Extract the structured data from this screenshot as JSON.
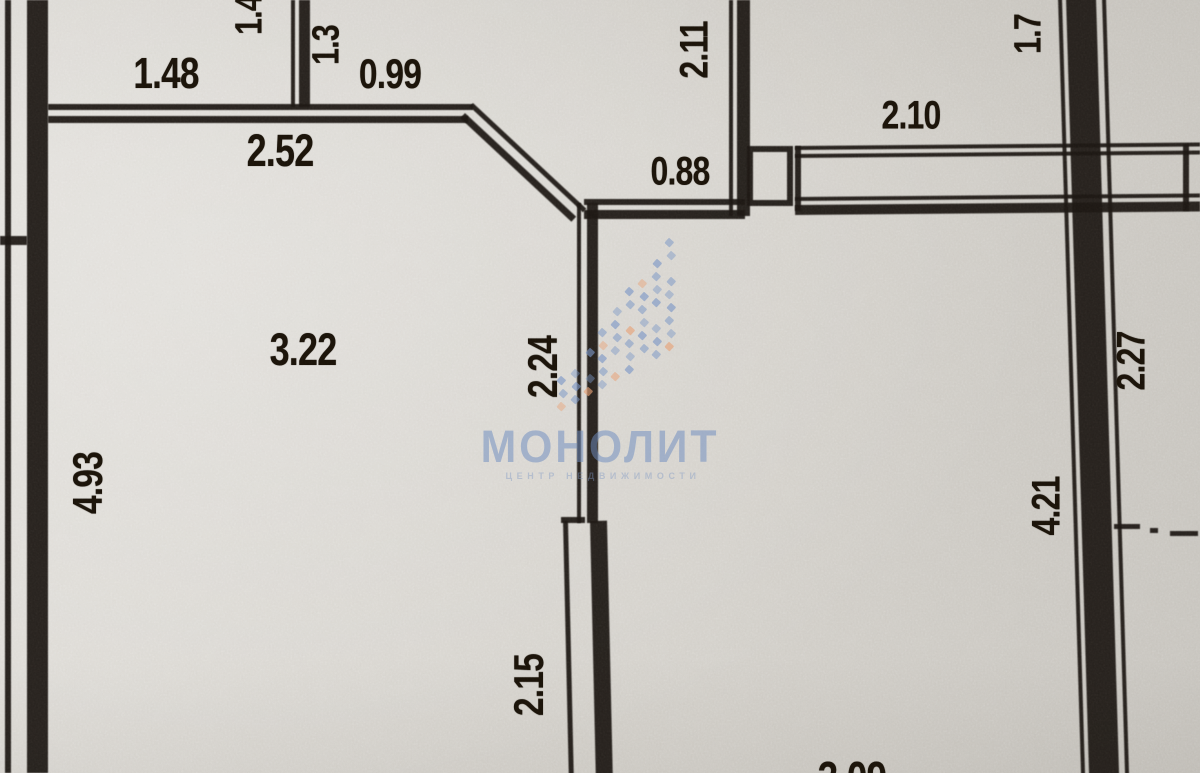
{
  "watermark": {
    "brand": "МОНОЛИТ",
    "tagline": "ЦЕНТР НЕДВИЖИМОСТИ",
    "brand_color": "#6f8dc0",
    "tagline_color": "#7d97c4",
    "brand_cx": 600,
    "brand_cy": 447,
    "brand_fs": 45,
    "tagline_cx": 603,
    "tagline_cy": 476,
    "tagline_fs": 9,
    "tagline_ls": 4.6,
    "logo": {
      "x0": 558,
      "col_step": 13.5,
      "y_base": 403,
      "base_step": 7.5,
      "row_step": 13,
      "cols": 9,
      "dot": 6.5,
      "blue": "#7b97c6",
      "orange": "#e8a176"
    }
  },
  "floorplan": {
    "paper_color": "#d8d5cf",
    "ink_color": "#1c1713",
    "dimensions": [
      {
        "text": "1.48",
        "cx": 166,
        "cy": 74,
        "rot": 0,
        "fs": 44
      },
      {
        "text": "1.4",
        "cx": 250,
        "cy": 15,
        "rot": -90,
        "fs": 38
      },
      {
        "text": "1.3",
        "cx": 327,
        "cy": 45,
        "rot": -90,
        "fs": 38
      },
      {
        "text": "0.99",
        "cx": 390,
        "cy": 74,
        "rot": 0,
        "fs": 42
      },
      {
        "text": "2.52",
        "cx": 280,
        "cy": 151,
        "rot": 0,
        "fs": 45
      },
      {
        "text": "2.11",
        "cx": 695,
        "cy": 50,
        "rot": -90,
        "fs": 40
      },
      {
        "text": "0.88",
        "cx": 680,
        "cy": 172,
        "rot": 0,
        "fs": 40
      },
      {
        "text": "2.10",
        "cx": 911,
        "cy": 116,
        "rot": 0,
        "fs": 40
      },
      {
        "text": "1.7",
        "cx": 1029,
        "cy": 34,
        "rot": -90,
        "fs": 38
      },
      {
        "text": "3.22",
        "cx": 303,
        "cy": 350,
        "rot": 0,
        "fs": 45
      },
      {
        "text": "2.24",
        "cx": 543,
        "cy": 367,
        "rot": -90,
        "fs": 42
      },
      {
        "text": "4.93",
        "cx": 88,
        "cy": 483,
        "rot": -90,
        "fs": 42
      },
      {
        "text": "2.15",
        "cx": 529,
        "cy": 685,
        "rot": -90,
        "fs": 42
      },
      {
        "text": "4.21",
        "cx": 1047,
        "cy": 506,
        "rot": -90,
        "fs": 40
      },
      {
        "text": "2.27",
        "cx": 1132,
        "cy": 361,
        "rot": -90,
        "fs": 40
      },
      {
        "text": "3.09",
        "cx": 852,
        "cy": 778,
        "rot": 0,
        "fs": 46
      }
    ],
    "walls": [
      {
        "name": "left-wall-outer-line",
        "x": 5,
        "y": 0,
        "w": 6,
        "h": 773
      },
      {
        "name": "left-wall",
        "x": 27,
        "y": 0,
        "w": 21,
        "h": 773
      },
      {
        "name": "left-stub-wall",
        "x": 0,
        "y": 236,
        "w": 27,
        "h": 9
      },
      {
        "name": "top-wall-line-a",
        "x": 48,
        "y": 104,
        "w": 425,
        "h": 6
      },
      {
        "name": "top-wall-line-b",
        "x": 48,
        "y": 116,
        "w": 420,
        "h": 7
      },
      {
        "name": "balcony-partition-thin",
        "x": 291,
        "y": 0,
        "w": 4,
        "h": 107
      },
      {
        "name": "balcony-partition",
        "x": 299,
        "y": 0,
        "w": 11,
        "h": 107
      },
      {
        "name": "diagonal-wall-line-a",
        "x": 473,
        "y": 103,
        "w": 155,
        "h": 5,
        "rot": 43
      },
      {
        "name": "diagonal-wall-line-b",
        "x": 465,
        "y": 113,
        "w": 152,
        "h": 7,
        "rot": 43
      },
      {
        "name": "entry-wall-line-a",
        "x": 584,
        "y": 199,
        "w": 161,
        "h": 6
      },
      {
        "name": "entry-wall-line-b",
        "x": 584,
        "y": 210,
        "w": 161,
        "h": 9
      },
      {
        "name": "hall-wall-thin",
        "x": 729,
        "y": 0,
        "w": 4,
        "h": 216
      },
      {
        "name": "hall-wall",
        "x": 737,
        "y": 0,
        "w": 13,
        "h": 216
      },
      {
        "name": "door-pier",
        "x": 747,
        "y": 146,
        "w": 46,
        "h": 60,
        "type": "outline"
      },
      {
        "name": "corridor-wall-top-a",
        "x": 795,
        "y": 146,
        "w": 405,
        "h": 4,
        "rot": -0.5
      },
      {
        "name": "corridor-wall-top-b",
        "x": 795,
        "y": 154,
        "w": 405,
        "h": 4,
        "rot": -0.5
      },
      {
        "name": "corridor-wall-bottom-a",
        "x": 795,
        "y": 197,
        "w": 405,
        "h": 4,
        "rot": -0.5
      },
      {
        "name": "corridor-wall-bottom-b",
        "x": 795,
        "y": 205,
        "w": 405,
        "h": 10,
        "rot": -0.5
      },
      {
        "name": "corridor-wall-left-jamb",
        "x": 795,
        "y": 146,
        "w": 6,
        "h": 65
      },
      {
        "name": "corridor-wall-right-jamb",
        "x": 1183,
        "y": 144,
        "w": 6,
        "h": 67
      },
      {
        "name": "main-wall-edge-left",
        "x": 1058,
        "y": -2,
        "w": 4,
        "h": 782,
        "rot": -1.7
      },
      {
        "name": "main-wall",
        "x": 1066,
        "y": -2,
        "w": 30,
        "h": 782,
        "rot": -1.7
      },
      {
        "name": "main-wall-edge-right",
        "x": 1102,
        "y": -2,
        "w": 4,
        "h": 782,
        "rot": -1.7
      },
      {
        "name": "center-wall-upper-thin",
        "x": 577,
        "y": 203,
        "w": 4,
        "h": 320
      },
      {
        "name": "center-wall-upper",
        "x": 587,
        "y": 203,
        "w": 11,
        "h": 320
      },
      {
        "name": "center-wall-jog",
        "x": 561,
        "y": 517,
        "w": 24,
        "h": 6
      },
      {
        "name": "center-wall-lower-thin",
        "x": 563,
        "y": 521,
        "w": 5,
        "h": 254,
        "rot": -1.3
      },
      {
        "name": "center-wall-lower",
        "x": 590,
        "y": 521,
        "w": 17,
        "h": 254,
        "rot": -1.3
      },
      {
        "name": "axis-dash-a",
        "x": 1114,
        "y": 524,
        "w": 26,
        "h": 5
      },
      {
        "name": "axis-dash-dot",
        "x": 1150,
        "y": 528,
        "w": 8,
        "h": 5
      },
      {
        "name": "axis-dash-b",
        "x": 1170,
        "y": 531,
        "w": 28,
        "h": 5
      }
    ]
  }
}
